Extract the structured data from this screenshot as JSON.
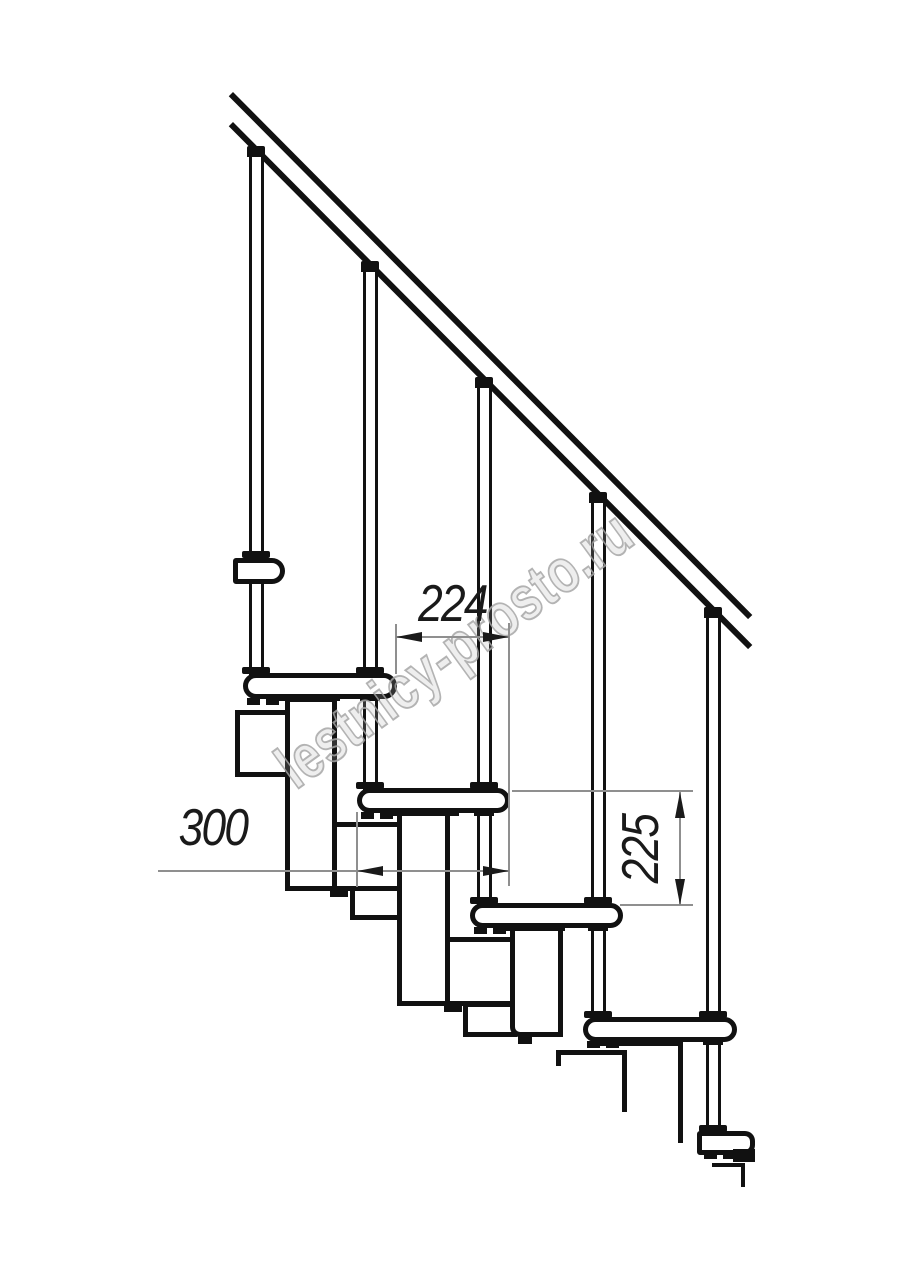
{
  "drawing": {
    "dimensions": {
      "going": {
        "value": "224"
      },
      "tread_depth": {
        "value": "300"
      },
      "rise": {
        "value": "225"
      }
    },
    "watermark": {
      "text": "lestnicy-prosto.ru"
    },
    "colors": {
      "background": "#ffffff",
      "line": "#111111",
      "dimension_line": "#8f8f8f",
      "text": "#1a1a1a",
      "watermark": "#a6a6a6"
    }
  }
}
